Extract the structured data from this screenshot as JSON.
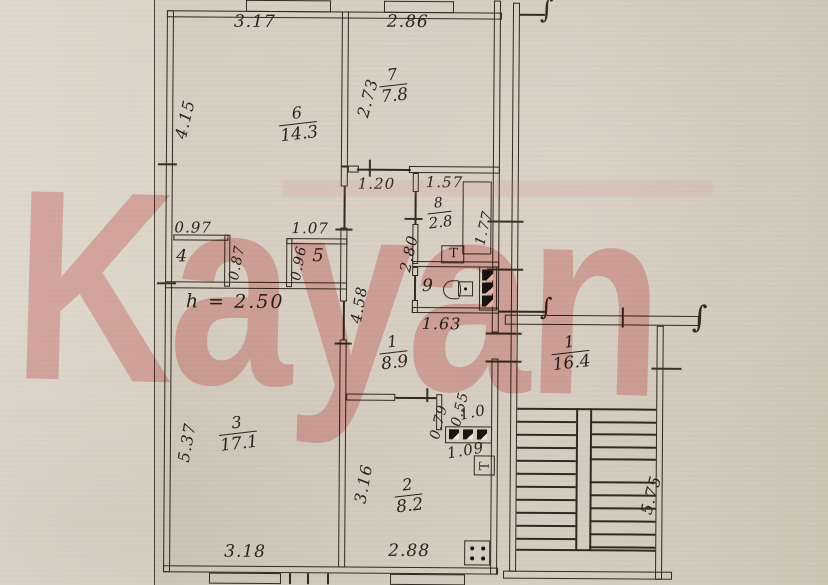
{
  "watermark_text": "Kayan",
  "plan": {
    "rooms": {
      "room6": {
        "num": "6",
        "area": "14.3"
      },
      "room7": {
        "num": "7",
        "area": "7.8"
      },
      "bath8": {
        "num": "8",
        "area": "2.8"
      },
      "wc9": {
        "num": "9"
      },
      "closet4": {
        "num": "4"
      },
      "closet5": {
        "num": "5"
      },
      "hall1": {
        "num": "1",
        "area": "8.9"
      },
      "room3": {
        "num": "3",
        "area": "17.1"
      },
      "kitchen2": {
        "num": "2",
        "area": "8.2"
      },
      "neighbor1": {
        "num": "1",
        "area": "16.4"
      }
    },
    "dims": {
      "top_w_left": "3.17",
      "top_w_right": "2.86",
      "left_h_top": "4.15",
      "room7_h": "2.73",
      "hall_w": "1.20",
      "bath_w": "1.57",
      "tub_h": "1.77",
      "bath_h": "2.80",
      "hall_h": "4.58",
      "closet4_w": "0.97",
      "closet5_w": "1.07",
      "closet4_d": "0.87",
      "closet5_d": "0.96",
      "wc_w": "1.63",
      "room3_h": "5.37",
      "kitchen_h": "3.16",
      "bottom_w_left": "3.18",
      "bottom_w_right": "2.88",
      "niche_h": "0.79",
      "niche_w": "0.55",
      "vent_w": "1.0",
      "vent_w2": "1.09",
      "stair_h": "5.75",
      "height_note": "h = 2.50"
    },
    "icons": {
      "wall_break": "∫",
      "bath_heater": "T",
      "entry_marker": "T"
    }
  }
}
